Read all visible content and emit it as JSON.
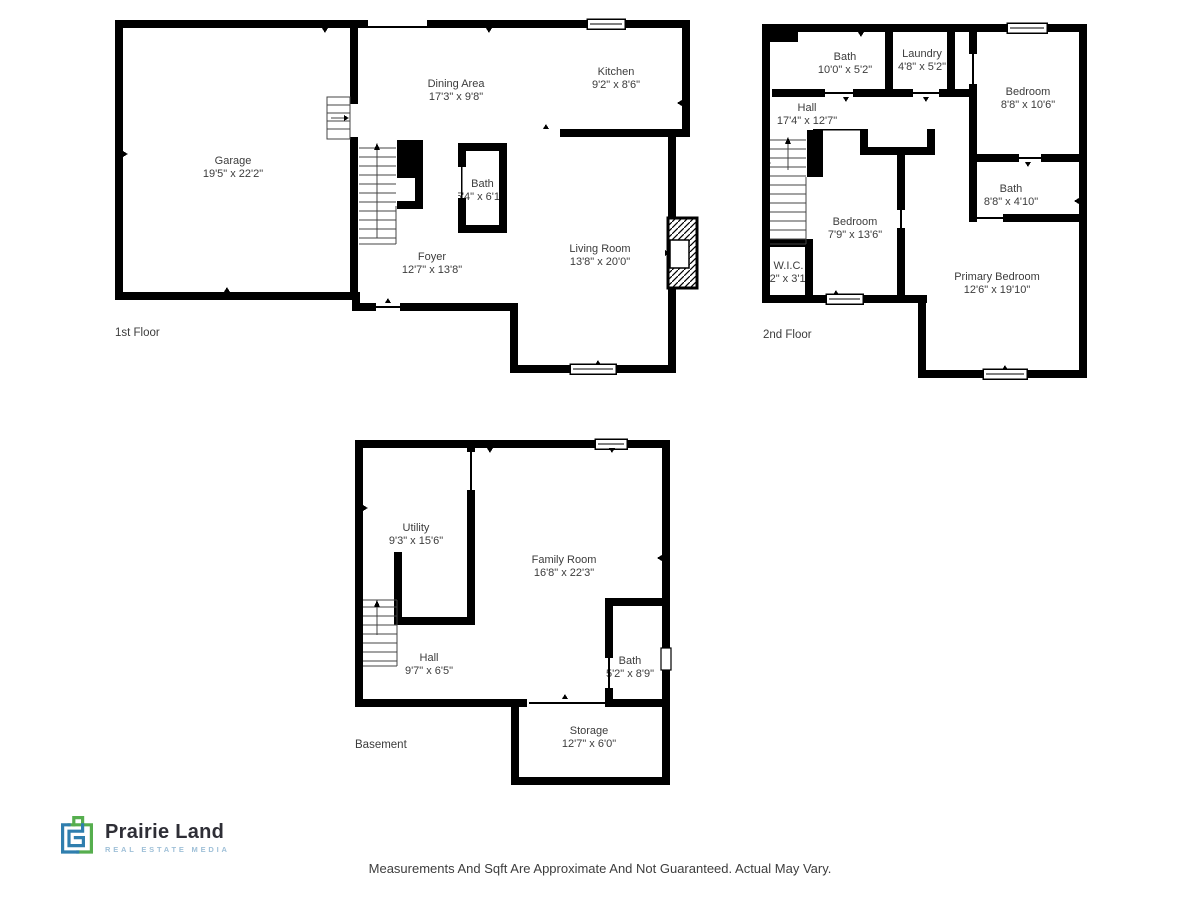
{
  "page": {
    "background": "#ffffff",
    "wall_color": "#000000",
    "label_color": "#3c3c3c",
    "disclaimer": "Measurements And Sqft Are Approximate And Not Guaranteed. Actual May Vary."
  },
  "logo": {
    "name": "Prairie Land",
    "subtitle": "REAL ESTATE MEDIA",
    "icon": "house-maze-logo-icon",
    "colors": {
      "blue": "#2f7eae",
      "green": "#56ae4e",
      "name_text": "#2e2e36",
      "subtitle_text": "#9fc0d8"
    }
  },
  "floors": [
    {
      "id": "first",
      "label": "1st Floor",
      "rooms": [
        {
          "name": "Garage",
          "dims": "19'5\" x 22'2\""
        },
        {
          "name": "Dining Area",
          "dims": "17'3\" x 9'8\""
        },
        {
          "name": "Kitchen",
          "dims": "9'2\" x 8'6\""
        },
        {
          "name": "Bath",
          "dims": "5'4\" x 6'11\""
        },
        {
          "name": "Foyer",
          "dims": "12'7\" x 13'8\""
        },
        {
          "name": "Living Room",
          "dims": "13'8\" x 20'0\""
        }
      ]
    },
    {
      "id": "second",
      "label": "2nd Floor",
      "rooms": [
        {
          "name": "Bath",
          "dims": "10'0\" x 5'2\""
        },
        {
          "name": "Laundry",
          "dims": "4'8\" x 5'2\""
        },
        {
          "name": "Bedroom",
          "dims": "8'8\" x 10'6\""
        },
        {
          "name": "Hall",
          "dims": "17'4\" x 12'7\""
        },
        {
          "name": "Bath",
          "dims": "8'8\" x 4'10\""
        },
        {
          "name": "Bedroom",
          "dims": "7'9\" x 13'6\""
        },
        {
          "name": "W.I.C.",
          "dims": "4'2\" x 3'10\""
        },
        {
          "name": "Primary Bedroom",
          "dims": "12'6\" x 19'10\""
        }
      ]
    },
    {
      "id": "basement",
      "label": "Basement",
      "rooms": [
        {
          "name": "Utility",
          "dims": "9'3\" x 15'6\""
        },
        {
          "name": "Family Room",
          "dims": "16'8\" x 22'3\""
        },
        {
          "name": "Hall",
          "dims": "9'7\" x 6'5\""
        },
        {
          "name": "Bath",
          "dims": "5'2\" x 8'9\""
        },
        {
          "name": "Storage",
          "dims": "12'7\" x 6'0\""
        }
      ]
    }
  ]
}
